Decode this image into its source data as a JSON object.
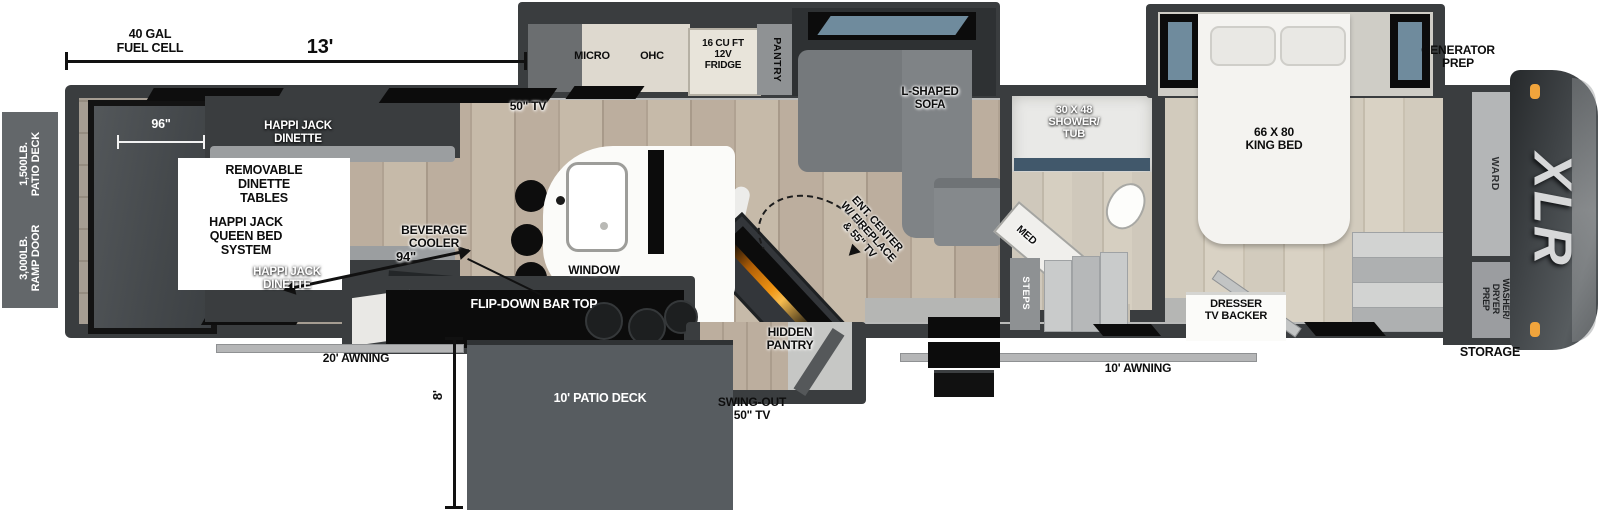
{
  "title": "XLR toy hauler fifth wheel floorplan",
  "brand": {
    "logo": "XLR"
  },
  "dims": {
    "fuel_cell": "40 GAL\nFUEL CELL",
    "garage_length": "13'",
    "ramp_width": "96\"",
    "interior_width": "94\"",
    "deck_depth": "8'"
  },
  "exterior": {
    "patio_rating": "1,500LB.\nPATIO DECK",
    "ramp_rating": "3,000LB.\nRAMP DOOR",
    "awning_left": "20' AWNING",
    "awning_right": "10' AWNING",
    "patio_deck": "10' PATIO DECK",
    "swing_tv": "SWING-OUT\n50\" TV",
    "generator": "GENERATOR\nPREP",
    "storage": "STORAGE"
  },
  "garage": {
    "dinette_top": "HAPPI JACK\nDINETTE",
    "dinette_bottom": "HAPPI JACK\nDINETTE",
    "tables_note": "REMOVABLE\nDINETTE\nTABLES",
    "bed_note": "HAPPI JACK\nQUEEN BED\nSYSTEM",
    "tv": "50\" TV"
  },
  "kitchen": {
    "micro": "MICRO",
    "ohc": "OHC",
    "fridge": "16 CU FT\n12V\nFRIDGE",
    "pantry": "PANTRY",
    "window": "WINDOW",
    "bev_cooler": "BEVERAGE\nCOOLER",
    "bar_top": "FLIP-DOWN BAR TOP",
    "hidden_pantry": "HIDDEN\nPANTRY"
  },
  "living": {
    "sofa": "L-SHAPED\nSOFA",
    "ent_center": "ENT. CENTER\nW/ FIREPLACE\n& 55\" TV"
  },
  "bath": {
    "shower": "30 X 48\nSHOWER/\nTUB",
    "med": "MED",
    "steps": "STEPS"
  },
  "bedroom": {
    "bed": "66 X 80\nKING BED",
    "dresser": "DRESSER\nTV BACKER",
    "wardrobe": "WARD",
    "washer": "WASHER/\nDRYER\nPREP"
  },
  "colors": {
    "wall": "#3a3d3f",
    "flame": "#ef9413",
    "marker_light": "#f0a43c",
    "deck": "#575c60"
  }
}
